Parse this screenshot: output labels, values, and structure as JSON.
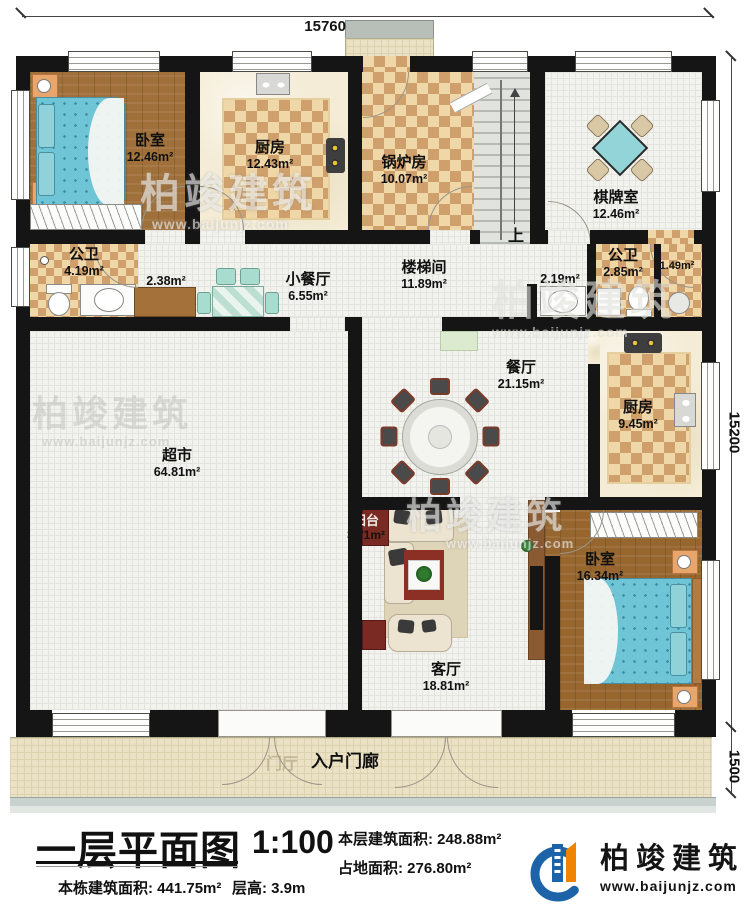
{
  "dimensions": {
    "top": "15760",
    "right": "15200",
    "porch_right": "1500"
  },
  "stairs": {
    "up": "上"
  },
  "rooms": {
    "bedroom_tl": {
      "name": "卧室",
      "area": "12.46m²"
    },
    "kitchen_tl": {
      "name": "厨房",
      "area": "12.43m²"
    },
    "boiler": {
      "name": "锅炉房",
      "area": "10.07m²"
    },
    "chess": {
      "name": "棋牌室",
      "area": "12.46m²"
    },
    "bath_left": {
      "name": "公卫",
      "area": "4.19m²"
    },
    "closet": {
      "area": "2.38m²"
    },
    "dining_small": {
      "name": "小餐厅",
      "area": "6.55m²"
    },
    "stairwell": {
      "name": "楼梯间",
      "area": "11.89m²"
    },
    "vanity": {
      "area": "2.19m²"
    },
    "bath_right": {
      "name": "公卫",
      "area": "2.85m²"
    },
    "wc": {
      "area": "1.49m²"
    },
    "dining": {
      "name": "餐厅",
      "area": "21.15m²"
    },
    "kitchen_r": {
      "name": "厨房",
      "area": "9.45m²"
    },
    "market": {
      "name": "超市",
      "area": "64.81m²"
    },
    "balcony": {
      "name": "阳台",
      "area": "3.71m²"
    },
    "living": {
      "name": "客厅",
      "area": "18.81m²"
    },
    "bedroom_br": {
      "name": "卧室",
      "area": "16.34m²"
    },
    "entry_porch": {
      "name": "入户门廊"
    },
    "foyer_faint": {
      "name": "门厅"
    }
  },
  "title_block": {
    "title": "一层平面图",
    "scale": "1:100",
    "floor_area": "本层建筑面积: 248.88m²",
    "footprint_area": "占地面积: 276.80m²",
    "total_area": "本栋建筑面积: 441.75m²",
    "floor_height": "层高: 3.9m"
  },
  "logo": {
    "name": "柏竣建筑",
    "url": "www.baijunjz.com"
  },
  "watermark": {
    "text": "柏竣建筑",
    "url": "www.baijunjz.com"
  },
  "colors": {
    "wall": "#151515",
    "logo_blue": "#1c63a8",
    "logo_orange": "#f08300",
    "bed": "#6fc4d6",
    "checker_dark": "#cfa06b",
    "checker_light": "#f0d7a8"
  }
}
